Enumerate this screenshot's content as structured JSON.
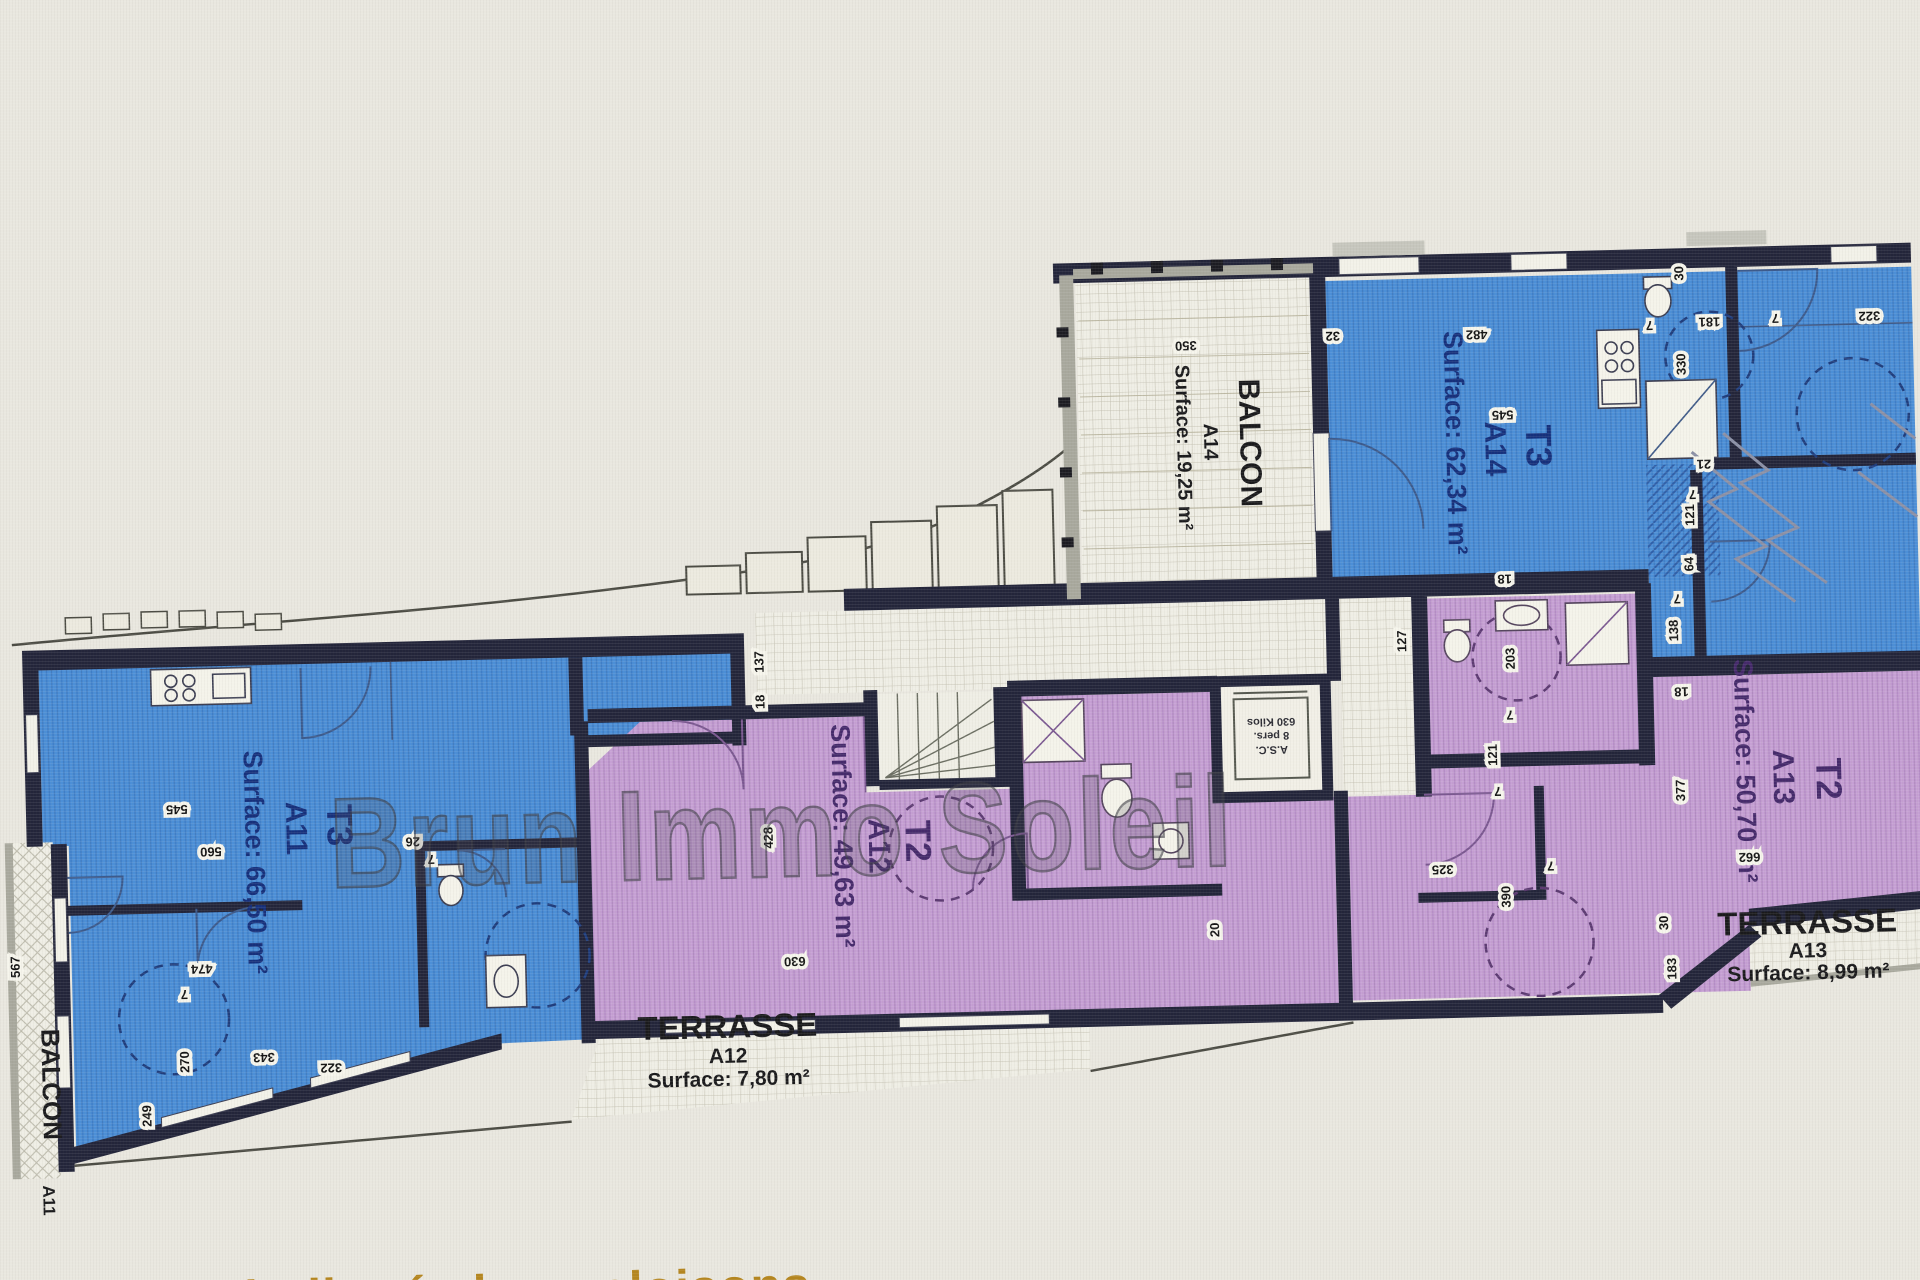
{
  "watermark": "Brun Immo Soleil",
  "bottom_note": "Superficie indiquée hors cloisons",
  "colors": {
    "apartment_blue": "#4c8fd7",
    "apartment_purple": "#c6a0d4",
    "wall": "#23253a",
    "label_blue": "#16307c",
    "label_purple": "#452a6b",
    "paper": "#efeee5",
    "note_orange": "#b5861f"
  },
  "apartments": [
    {
      "id": "A11",
      "type": "T3",
      "surface": "Surface: 66,50 m²"
    },
    {
      "id": "A12",
      "type": "T2",
      "surface": "Surface: 49,63 m²"
    },
    {
      "id": "A13",
      "type": "T2",
      "surface": "Surface: 50,70 m²"
    },
    {
      "id": "A14",
      "type": "T3",
      "surface": "Surface: 62,34 m²"
    }
  ],
  "areas": {
    "balcon_a14": {
      "title": "BALCON",
      "id": "A14",
      "surface": "Surface: 19,25 m²"
    },
    "balcon_a11": {
      "title": "BALCON",
      "id": "A11"
    },
    "terrasse_a12": {
      "title": "TERRASSE",
      "id": "A12",
      "surface": "Surface: 7,80 m²"
    },
    "terrasse_a13": {
      "title": "TERRASSE",
      "id": "A13",
      "surface": "Surface: 8,99 m²"
    }
  },
  "elevator": {
    "line1": "A.S.C.",
    "line2": "8 pers.",
    "line3": "630 Kilos"
  },
  "dimensions": [
    {
      "v": "350",
      "x": 1193,
      "y": 347,
      "r": 180
    },
    {
      "v": "32",
      "x": 1340,
      "y": 341,
      "r": 180
    },
    {
      "v": "482",
      "x": 1484,
      "y": 343,
      "r": 180
    },
    {
      "v": "545",
      "x": 1508,
      "y": 424,
      "r": 180
    },
    {
      "v": "18",
      "x": 1506,
      "y": 588,
      "r": 180
    },
    {
      "v": "30",
      "x": 1692,
      "y": 291,
      "r": -90
    },
    {
      "v": "181",
      "x": 1717,
      "y": 336,
      "r": 180
    },
    {
      "v": "7",
      "x": 1657,
      "y": 338,
      "r": 180
    },
    {
      "v": "330",
      "x": 1692,
      "y": 382,
      "r": -90
    },
    {
      "v": "7",
      "x": 1783,
      "y": 334,
      "r": 180
    },
    {
      "v": "322",
      "x": 1877,
      "y": 334,
      "r": 180
    },
    {
      "v": "21",
      "x": 1708,
      "y": 478,
      "r": 180
    },
    {
      "v": "7",
      "x": 1696,
      "y": 508,
      "r": 180
    },
    {
      "v": "121",
      "x": 1697,
      "y": 533,
      "r": -90
    },
    {
      "v": "64",
      "x": 1695,
      "y": 582,
      "r": -90
    },
    {
      "v": "7",
      "x": 1678,
      "y": 612,
      "r": 180
    },
    {
      "v": "138",
      "x": 1678,
      "y": 648,
      "r": -90
    },
    {
      "v": "18",
      "x": 1680,
      "y": 705,
      "r": 180
    },
    {
      "v": "127",
      "x": 1406,
      "y": 652,
      "r": -90
    },
    {
      "v": "137",
      "x": 763,
      "y": 657,
      "r": -90
    },
    {
      "v": "18",
      "x": 763,
      "y": 697,
      "r": -90
    },
    {
      "v": "545",
      "x": 173,
      "y": 786,
      "r": 180
    },
    {
      "v": "560",
      "x": 206,
      "y": 829,
      "r": 180
    },
    {
      "v": "26",
      "x": 408,
      "y": 824,
      "r": 180
    },
    {
      "v": "7",
      "x": 426,
      "y": 842,
      "r": 180
    },
    {
      "v": "474",
      "x": 194,
      "y": 946,
      "r": 180
    },
    {
      "v": "7",
      "x": 176,
      "y": 971,
      "r": 180
    },
    {
      "v": "270",
      "x": 179,
      "y": 1043,
      "r": -90
    },
    {
      "v": "343",
      "x": 254,
      "y": 1036,
      "r": 180
    },
    {
      "v": "322",
      "x": 321,
      "y": 1048,
      "r": 180
    },
    {
      "v": "567",
      "x": 12,
      "y": 944,
      "r": -90
    },
    {
      "v": "249",
      "x": 140,
      "y": 1096,
      "r": -90
    },
    {
      "v": "428",
      "x": 768,
      "y": 833,
      "r": -90
    },
    {
      "v": "630",
      "x": 787,
      "y": 953,
      "r": 180
    },
    {
      "v": "20",
      "x": 1212,
      "y": 936,
      "r": -90
    },
    {
      "v": "203",
      "x": 1514,
      "y": 672,
      "r": -90
    },
    {
      "v": "7",
      "x": 1508,
      "y": 724,
      "r": 180
    },
    {
      "v": "121",
      "x": 1494,
      "y": 768,
      "r": -90
    },
    {
      "v": "7",
      "x": 1494,
      "y": 800,
      "r": 180
    },
    {
      "v": "325",
      "x": 1437,
      "y": 877,
      "r": 180
    },
    {
      "v": "377",
      "x": 1681,
      "y": 808,
      "r": -90
    },
    {
      "v": "662",
      "x": 1744,
      "y": 872,
      "r": 180
    },
    {
      "v": "390",
      "x": 1504,
      "y": 910,
      "r": -90
    },
    {
      "v": "7",
      "x": 1545,
      "y": 876,
      "r": 180
    },
    {
      "v": "30",
      "x": 1661,
      "y": 940,
      "r": -90
    },
    {
      "v": "183",
      "x": 1668,
      "y": 986,
      "r": -90
    }
  ]
}
